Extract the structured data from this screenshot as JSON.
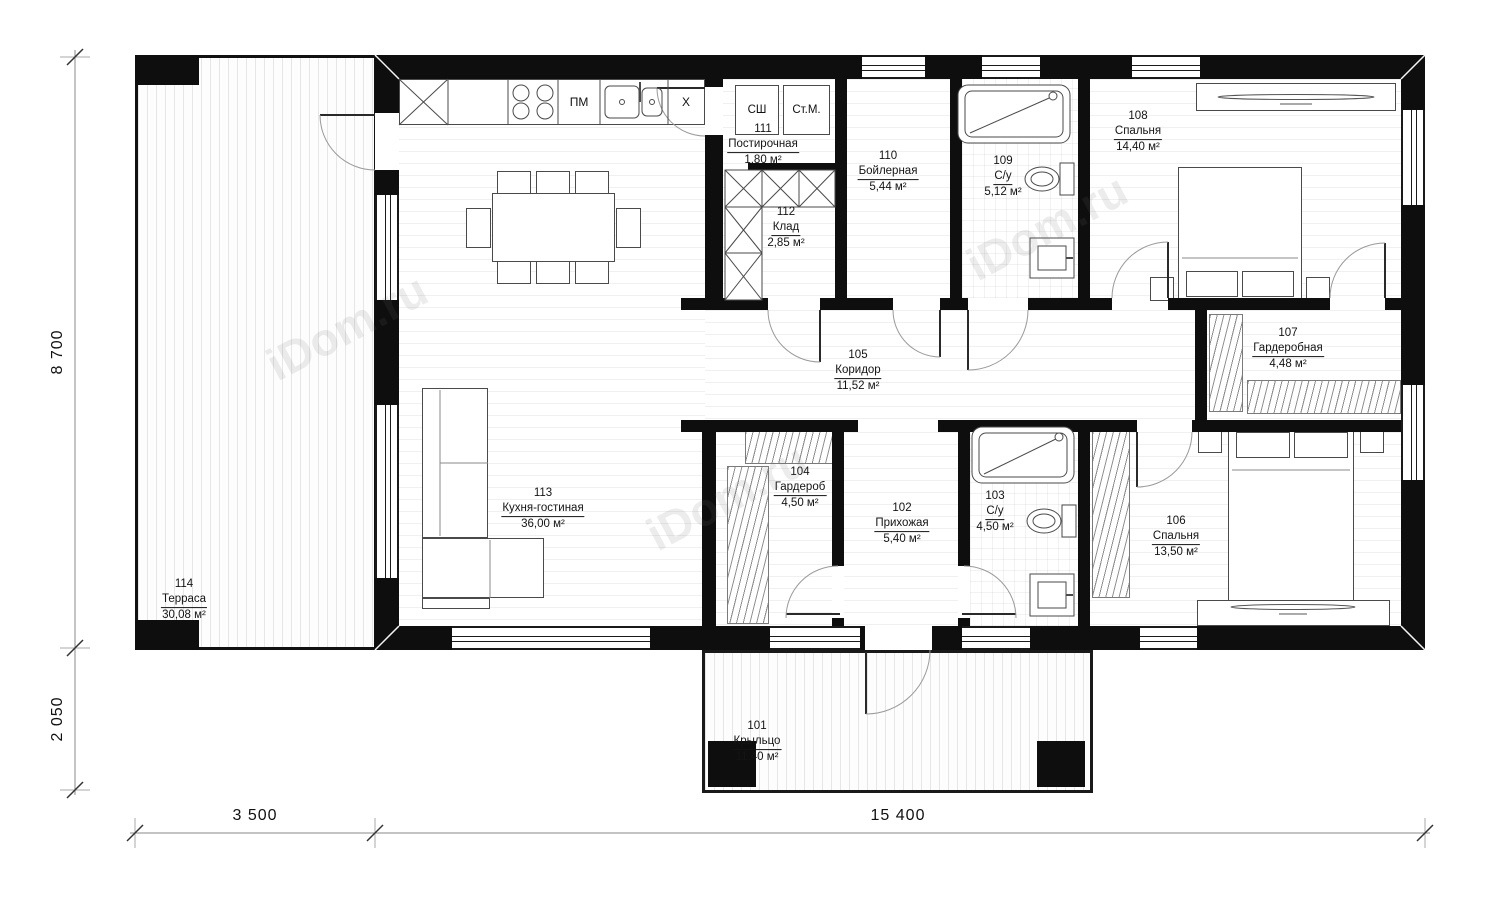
{
  "watermark": "iDom.ru",
  "dimensions": {
    "left_top": "8 700",
    "left_bottom": "2 050",
    "bottom_left": "3 500",
    "bottom_right": "15 400"
  },
  "appliances": {
    "dishwasher": "ПМ",
    "fridge": "Х",
    "drying_cabinet": "СШ",
    "washing_machine": "Ст.М."
  },
  "rooms": [
    {
      "number": "101",
      "name": "Крыльцо",
      "area": "11,40 м²"
    },
    {
      "number": "102",
      "name": "Прихожая",
      "area": "5,40 м²"
    },
    {
      "number": "103",
      "name": "С/у",
      "area": "4,50 м²"
    },
    {
      "number": "104",
      "name": "Гардероб",
      "area": "4,50 м²"
    },
    {
      "number": "105",
      "name": "Коридор",
      "area": "11,52 м²"
    },
    {
      "number": "106",
      "name": "Спальня",
      "area": "13,50 м²"
    },
    {
      "number": "107",
      "name": "Гардеробная",
      "area": "4,48 м²"
    },
    {
      "number": "108",
      "name": "Спальня",
      "area": "14,40 м²"
    },
    {
      "number": "109",
      "name": "С/у",
      "area": "5,12 м²"
    },
    {
      "number": "110",
      "name": "Бойлерная",
      "area": "5,44 м²"
    },
    {
      "number": "111",
      "name": "Постирочная",
      "area": "1,80 м²"
    },
    {
      "number": "112",
      "name": "Клад",
      "area": "2,85 м²"
    },
    {
      "number": "113",
      "name": "Кухня-гостиная",
      "area": "36,00 м²"
    },
    {
      "number": "114",
      "name": "Терраса",
      "area": "30,08 м²"
    }
  ]
}
